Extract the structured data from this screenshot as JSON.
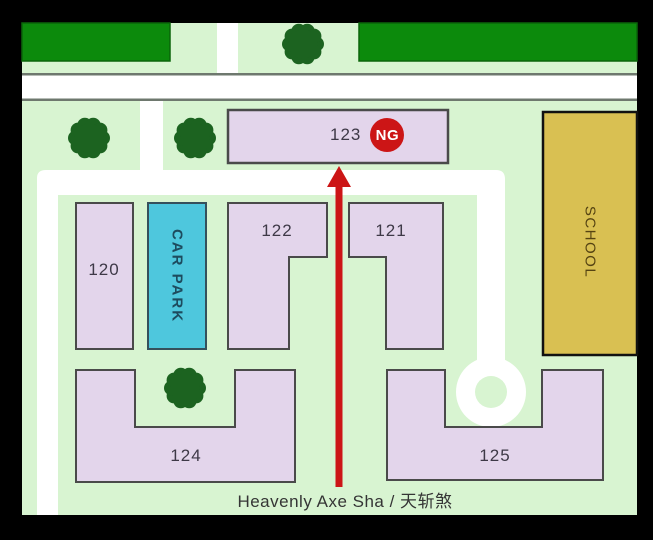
{
  "map": {
    "caption": "Heavenly Axe Sha / 天斩煞",
    "buildings": {
      "b120": "120",
      "b121": "121",
      "b122": "122",
      "b123": "123",
      "b124": "124",
      "b125": "125"
    },
    "car_park_label": "CAR PARK",
    "school_label": "SCHOOL",
    "ng_badge": "NG"
  },
  "colors": {
    "frame_black": "#000000",
    "grass_green": "#d8f4d1",
    "hedge_green": "#0c8a0c",
    "tree_green": "#1c6320",
    "building_fill": "#e3d5eb",
    "building_border": "#4a4a4a",
    "car_park_fill": "#4ec7dd",
    "school_fill": "#d9c052",
    "alert_red": "#cc1516",
    "road_white": "#ffffff",
    "road_edge_gray": "#6e786e"
  }
}
